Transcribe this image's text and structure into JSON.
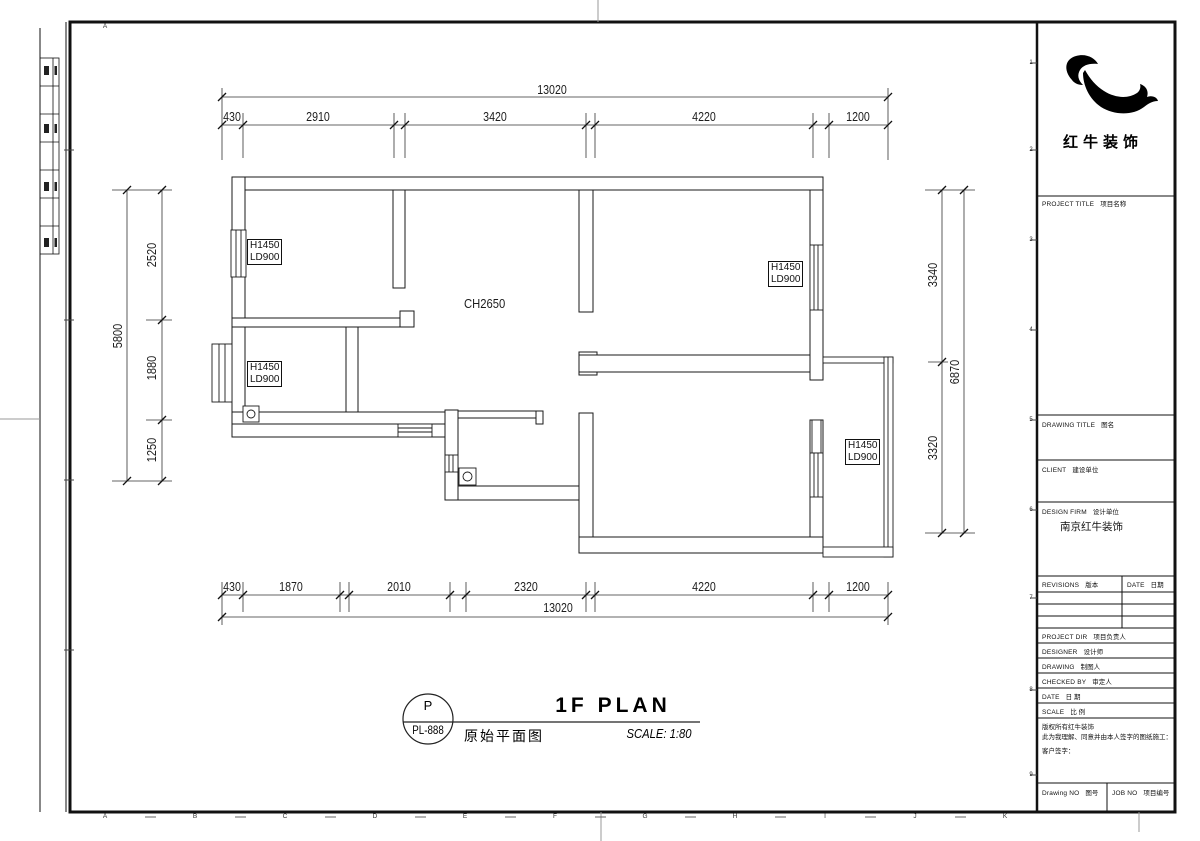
{
  "sheet": {
    "top_letter": "A",
    "bottom_letters": [
      "A",
      "B",
      "C",
      "D",
      "E",
      "F",
      "G",
      "H",
      "I",
      "J",
      "K"
    ],
    "row_numbers": [
      "1",
      "2",
      "3",
      "4",
      "5",
      "6",
      "7",
      "8",
      "9"
    ]
  },
  "logo": {
    "brand": "红牛装饰"
  },
  "title_block": {
    "project_title_en": "PROJECT TITLE",
    "project_title_zh": "项目名称",
    "drawing_title_en": "DRAWING TITLE",
    "drawing_title_zh": "图名",
    "client_en": "CLIENT",
    "client_zh": "建设单位",
    "design_firm_en": "DESIGN FIRM",
    "design_firm_zh": "设计单位",
    "design_firm_value": "南京红牛装饰",
    "revisions_en": "REVISIONS",
    "revisions_zh": "版本",
    "rev_date_en": "DATE",
    "rev_date_zh": "日期",
    "project_dir_en": "PROJECT DIR",
    "project_dir_zh": "项目负责人",
    "designer_en": "DESIGNER",
    "designer_zh": "设计师",
    "drawing_en": "DRAWING",
    "drawing_zh": "制图人",
    "checked_by_en": "CHECKED BY",
    "checked_by_zh": "审定人",
    "date_en": "DATE",
    "date_zh": "日 期",
    "scale_en": "SCALE",
    "scale_zh": "比 例",
    "note_line1": "版权所有红牛装饰",
    "note_line2": "此为我理解、同意并由本人签字的图纸施工：",
    "note_line3": "客户签字：",
    "drawing_no_en": "Drawing NO",
    "drawing_no_zh": "图号",
    "job_no_en": "JOB NO",
    "job_no_zh": "项目编号"
  },
  "plan": {
    "ceiling_label": "CH2650",
    "window_labels": [
      {
        "l1": "H1450",
        "l2": "LD900"
      },
      {
        "l1": "H1450",
        "l2": "LD900"
      },
      {
        "l1": "H1450",
        "l2": "LD900"
      },
      {
        "l1": "H1450",
        "l2": "LD900"
      }
    ]
  },
  "dims": {
    "top": {
      "overall": "13020",
      "segments": [
        "430",
        "2910",
        "3420",
        "4220",
        "1200"
      ]
    },
    "bottom": {
      "overall": "13020",
      "segments": [
        "430",
        "1870",
        "2010",
        "2320",
        "4220",
        "1200"
      ]
    },
    "left": {
      "overall": "5800",
      "segments": [
        "2520",
        "1880",
        "1250"
      ]
    },
    "right": {
      "overall": "6870",
      "segments": [
        "3340",
        "3320"
      ]
    }
  },
  "titlebar": {
    "tag": "P",
    "sheet_no": "PL-888",
    "title_en": "1F PLAN",
    "title_zh": "原始平面图",
    "scale_text": "SCALE: 1:80"
  }
}
